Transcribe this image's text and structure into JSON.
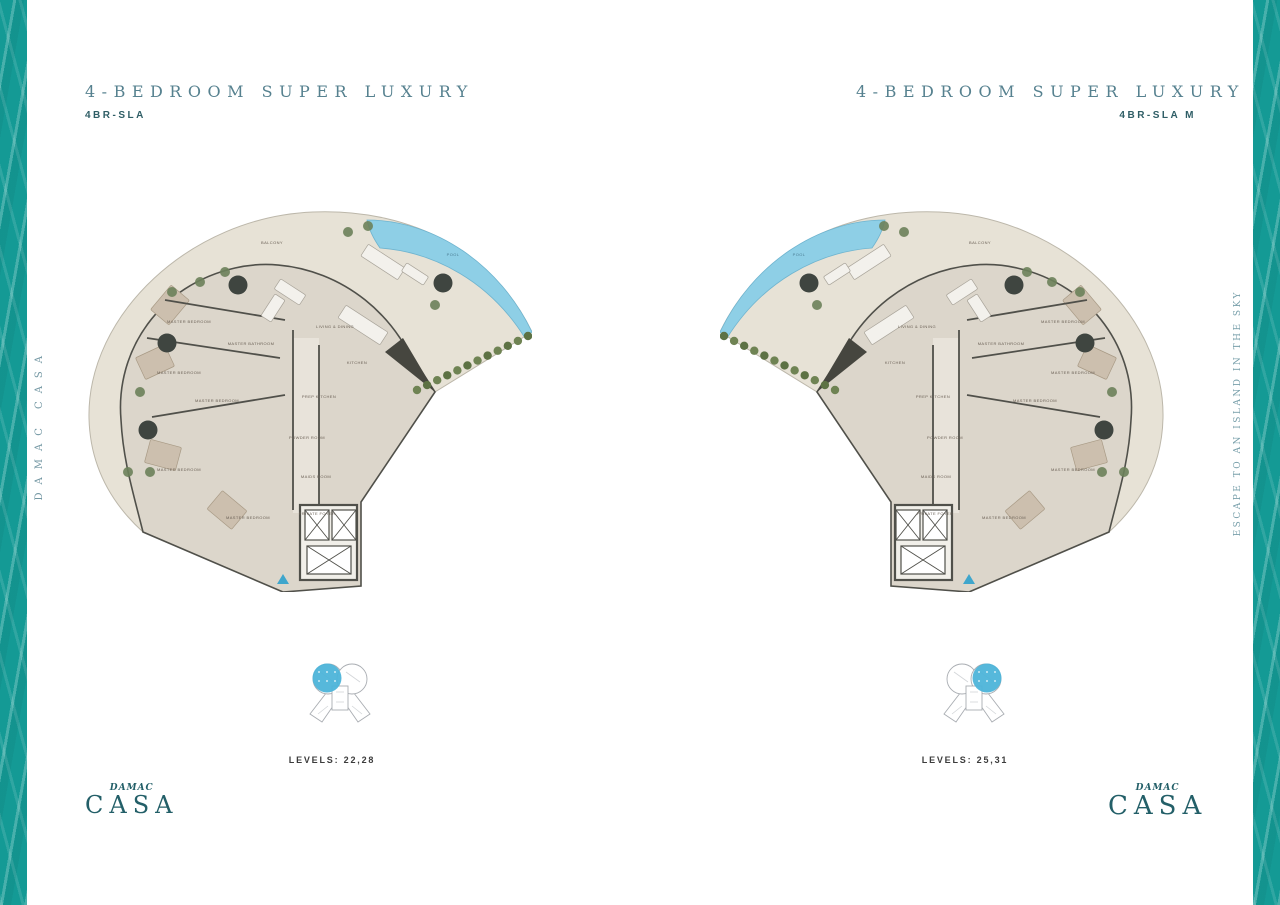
{
  "page": {
    "background": "#ffffff",
    "water_color": "#149a95"
  },
  "left_panel": {
    "title": "4-BEDROOM SUPER LUXURY",
    "code": "4BR-SLA",
    "levels": "LEVELS: 22,28",
    "key_highlight": "left"
  },
  "right_panel": {
    "title": "4-BEDROOM SUPER LUXURY",
    "code": "4BR-SLA M",
    "levels": "LEVELS: 25,31",
    "key_highlight": "right"
  },
  "side_text_left": "DAMAC CASA",
  "side_text_right": "ESCAPE TO AN ISLAND IN THE SKY",
  "logo": {
    "brand": "DAMAC",
    "name": "CASA"
  },
  "floorplan": {
    "colors": {
      "deck": "#e7e2d6",
      "deck_edge": "#bcb7aa",
      "interior": "#dcd6cb",
      "wall": "#50504a",
      "carpet": "#ccbfae",
      "pool": "#8ecfe6",
      "pool_edge": "#6fb4cf",
      "hedge": "#5d7244",
      "plant": "#6c815a",
      "tree": "#3f4540",
      "furniture": "#f3f1ec",
      "furniture_edge": "#a9a49a",
      "label": "#6b6156",
      "pool_label": "#4b7d94",
      "entry_marker": "#3fa6cc"
    },
    "rooms": [
      {
        "label": "BALCONY",
        "x": 187,
        "y": 34
      },
      {
        "label": "POOL",
        "x": 368,
        "y": 46,
        "pool": true
      },
      {
        "label": "LIVING & DINING",
        "x": 250,
        "y": 118
      },
      {
        "label": "KITCHEN",
        "x": 272,
        "y": 154
      },
      {
        "label": "PREP KITCHEN",
        "x": 234,
        "y": 188
      },
      {
        "label": "POWDER ROOM",
        "x": 222,
        "y": 229
      },
      {
        "label": "MAIDS ROOM",
        "x": 231,
        "y": 268
      },
      {
        "label": "PRIVATE FOYER",
        "x": 232,
        "y": 305
      },
      {
        "label": "MASTER BEDROOM",
        "x": 104,
        "y": 113
      },
      {
        "label": "MASTER BATHROOM",
        "x": 166,
        "y": 135
      },
      {
        "label": "MASTER BEDROOM",
        "x": 94,
        "y": 164
      },
      {
        "label": "MASTER BEDROOM",
        "x": 132,
        "y": 192
      },
      {
        "label": "MASTER BEDROOM",
        "x": 94,
        "y": 261
      },
      {
        "label": "MASTER BEDROOM",
        "x": 163,
        "y": 309
      }
    ]
  }
}
